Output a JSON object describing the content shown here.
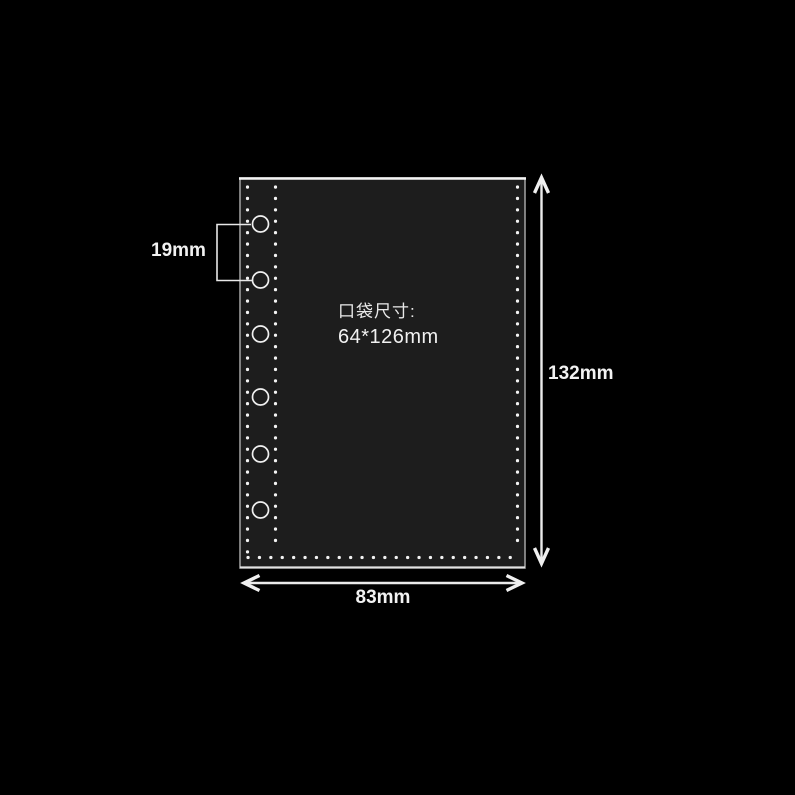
{
  "scene": {
    "background_color": "#000000"
  },
  "pocket": {
    "caption": {
      "line1": "口袋尺寸:",
      "line2": "64*126mm"
    },
    "fill_color": "#1d1d1d",
    "edge_color": "#d9d9d9",
    "stitch_color": "#f2f2f2",
    "hole_count": "6"
  },
  "dimensions": {
    "hole_spacing": {
      "label": "19mm"
    },
    "height": {
      "label": "132mm"
    },
    "width": {
      "label": "83mm"
    }
  }
}
